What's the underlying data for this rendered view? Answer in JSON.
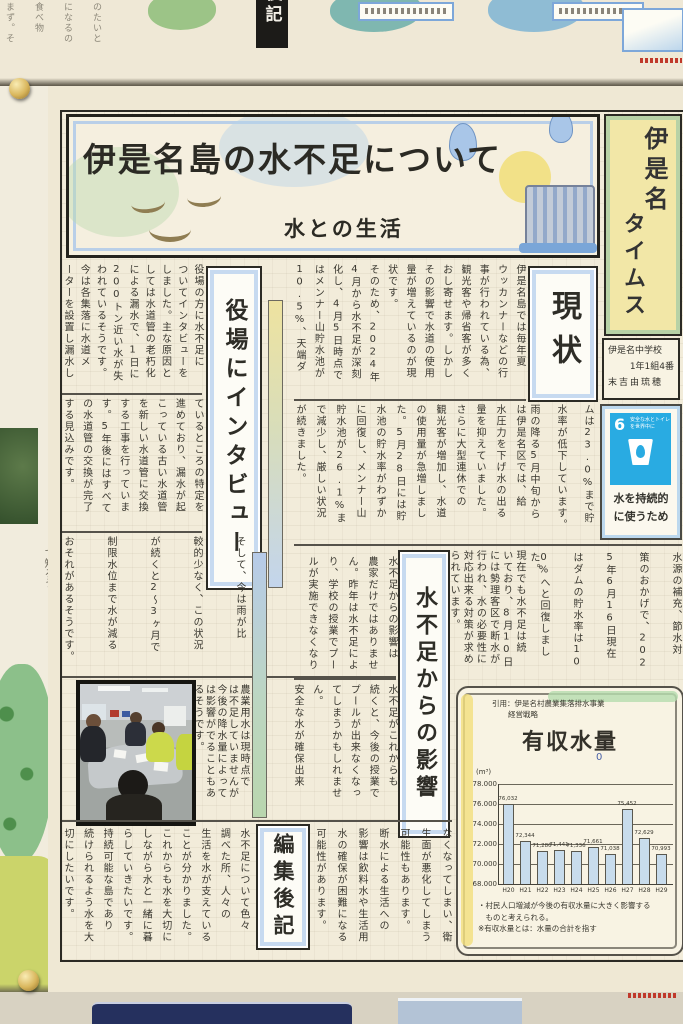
{
  "banner": {
    "title": "伊是名島の水不足について",
    "subtitle": "水との生活"
  },
  "masthead": {
    "title_right": "伊是名",
    "title_left": "タイムス",
    "school": "伊是名中学校",
    "class_line": "1年1組4番",
    "author": "末吉由琉穂"
  },
  "sdg": {
    "number": "6",
    "label_line1": "安全な水とトイレ",
    "label_line2": "を世界中に",
    "caption_line1": "水を持続的",
    "caption_line2": "に使うため"
  },
  "sections": {
    "genjo": {
      "heading": "現状",
      "block_a": [
        "伊是名島では毎年夏",
        "ウッカンナーなどの行",
        "事が行われている為、",
        "観光客や帰省客が多く",
        "おし寄せます。しかし",
        "その影響で水道の使用",
        "量が増えているのが現",
        "状です。",
        "そのため、2024年",
        "4月から水不足が深刻",
        "化し、4月5日時点で",
        "はメンナー山貯水池が",
        "10.5%、天端ダ"
      ],
      "block_b": [
        "は伊是名区では、給",
        "水圧力を下げ水の出る",
        "量を抑えていました。",
        "さらに大型連休での",
        "観光客が増加し、水道",
        "の使用量が急増しまし",
        "た。5月28日には貯",
        "水池の貯水率がわずか",
        "に回復し、メンナー山",
        "貯水池が26.1%ま",
        "で減少し、厳しい状況",
        "が続きました。"
      ],
      "block_c": [
        "ムは23.0%まで貯",
        "水率が低下しています。",
        "雨の降る5月中旬から"
      ],
      "block_d": [
        "水源の補充、節水対",
        "策のおかげで、202",
        "5年6月16日現在",
        "はダムの貯水率は10",
        "0%へと回復しました。"
      ],
      "block_e": [
        "現在でも水不足は続",
        "いており、8月10日",
        "には勢理客区で断水が",
        "行われ、水の必要性に",
        "対応出来る対策が求め",
        "られています。"
      ]
    },
    "interview": {
      "heading": "役場にインタビュー",
      "band1": [
        "役場の方に水不足に",
        "ついてインタビューを",
        "しました。主な原因と",
        "しては水道管の老朽化",
        "による漏水で、1日に",
        "200トン近い水が失",
        "われているそうです。",
        "今は各集落に水道メ",
        "ーターを設置し漏水し"
      ],
      "band2": [
        "ているところの特定を",
        "進めており、漏水が起",
        "こっている古い水道管",
        "を新しい水道管に交換",
        "する工事を行っていま",
        "す。5年後にはすべて",
        "の水道管の交換が完了",
        "する見込みです。"
      ],
      "band3": [
        "そして、今は雨が比",
        "較的少なく、この状況",
        "が続くと2〜3ヶ月で",
        "制限水位まで水が減る",
        "おそれがあるそうです。"
      ],
      "band4": [
        "農業用水は現時点で",
        "は不足していませんが",
        "今後の降水量によって",
        "は影響がでることもあ",
        "るそうです。"
      ]
    },
    "kage": {
      "heading": "水不足からの影響",
      "block1": [
        "水不足からの影響は",
        "農家だけではありませ",
        "ん。昨年は水不足によ",
        "り、学校の授業でプー",
        "ルが実施できなくなり"
      ],
      "block2": [
        "水不足がこれからも",
        "続くと、今後の授業で",
        "プールが出来なくなっ",
        "てしまうかもしれませ",
        "ん。",
        "安全な水が確保出来"
      ],
      "block3": [
        "なくなってしまい、衛",
        "生面が悪化してしまう",
        "可能性もあります。",
        "断水による生活への",
        "影響は飲料水や生活用",
        "水の確保が困難になる",
        "可能性があります。"
      ]
    },
    "editor": {
      "heading": "編集後記",
      "cols": [
        "水不足について色々",
        "調べた所、人々の",
        "生活を水が支えている",
        "ことが分かりました。",
        "これからも水を大切に",
        "しながら水と一緒に暮",
        "らしていきたいです。",
        "持続可能な島であり",
        "続けられるよう水を大",
        "切にしたいです。"
      ]
    }
  },
  "chart_data": {
    "type": "bar",
    "title": "有収水量",
    "title_mark": "0",
    "citation_line1": "引用：伊是名村農業集落排水事業",
    "citation_line2": "経営戦略",
    "unit": "(m³)",
    "categories": [
      "H20",
      "H21",
      "H22",
      "H23",
      "H24",
      "H25",
      "H26",
      "H27",
      "H28",
      "H29"
    ],
    "values": [
      76032,
      72344,
      71280,
      71441,
      71336,
      71661,
      71038,
      75452,
      72629,
      70993
    ],
    "labels": [
      "76,032",
      "72,344",
      "71,280",
      "71,441",
      "71,336",
      "71,661",
      "71,038",
      "75,452",
      "72,629",
      "70,993"
    ],
    "ylim": [
      68000,
      78000
    ],
    "yticks": [
      "78.000",
      "76.000",
      "74.000",
      "72.000",
      "70.000",
      "68.000"
    ],
    "grid": true,
    "notes": [
      "・村民人口増減が今後の有収水量に大きく影響する",
      "　ものと考えられる。",
      "※有収水量とは：水量の合計を指す"
    ]
  },
  "decor": {
    "top_fragments": [
      "のたいと",
      "になるの",
      "食べ物",
      "まず。そ"
    ],
    "top_box_label": "後記",
    "left_fragment": "て知ろう！"
  }
}
